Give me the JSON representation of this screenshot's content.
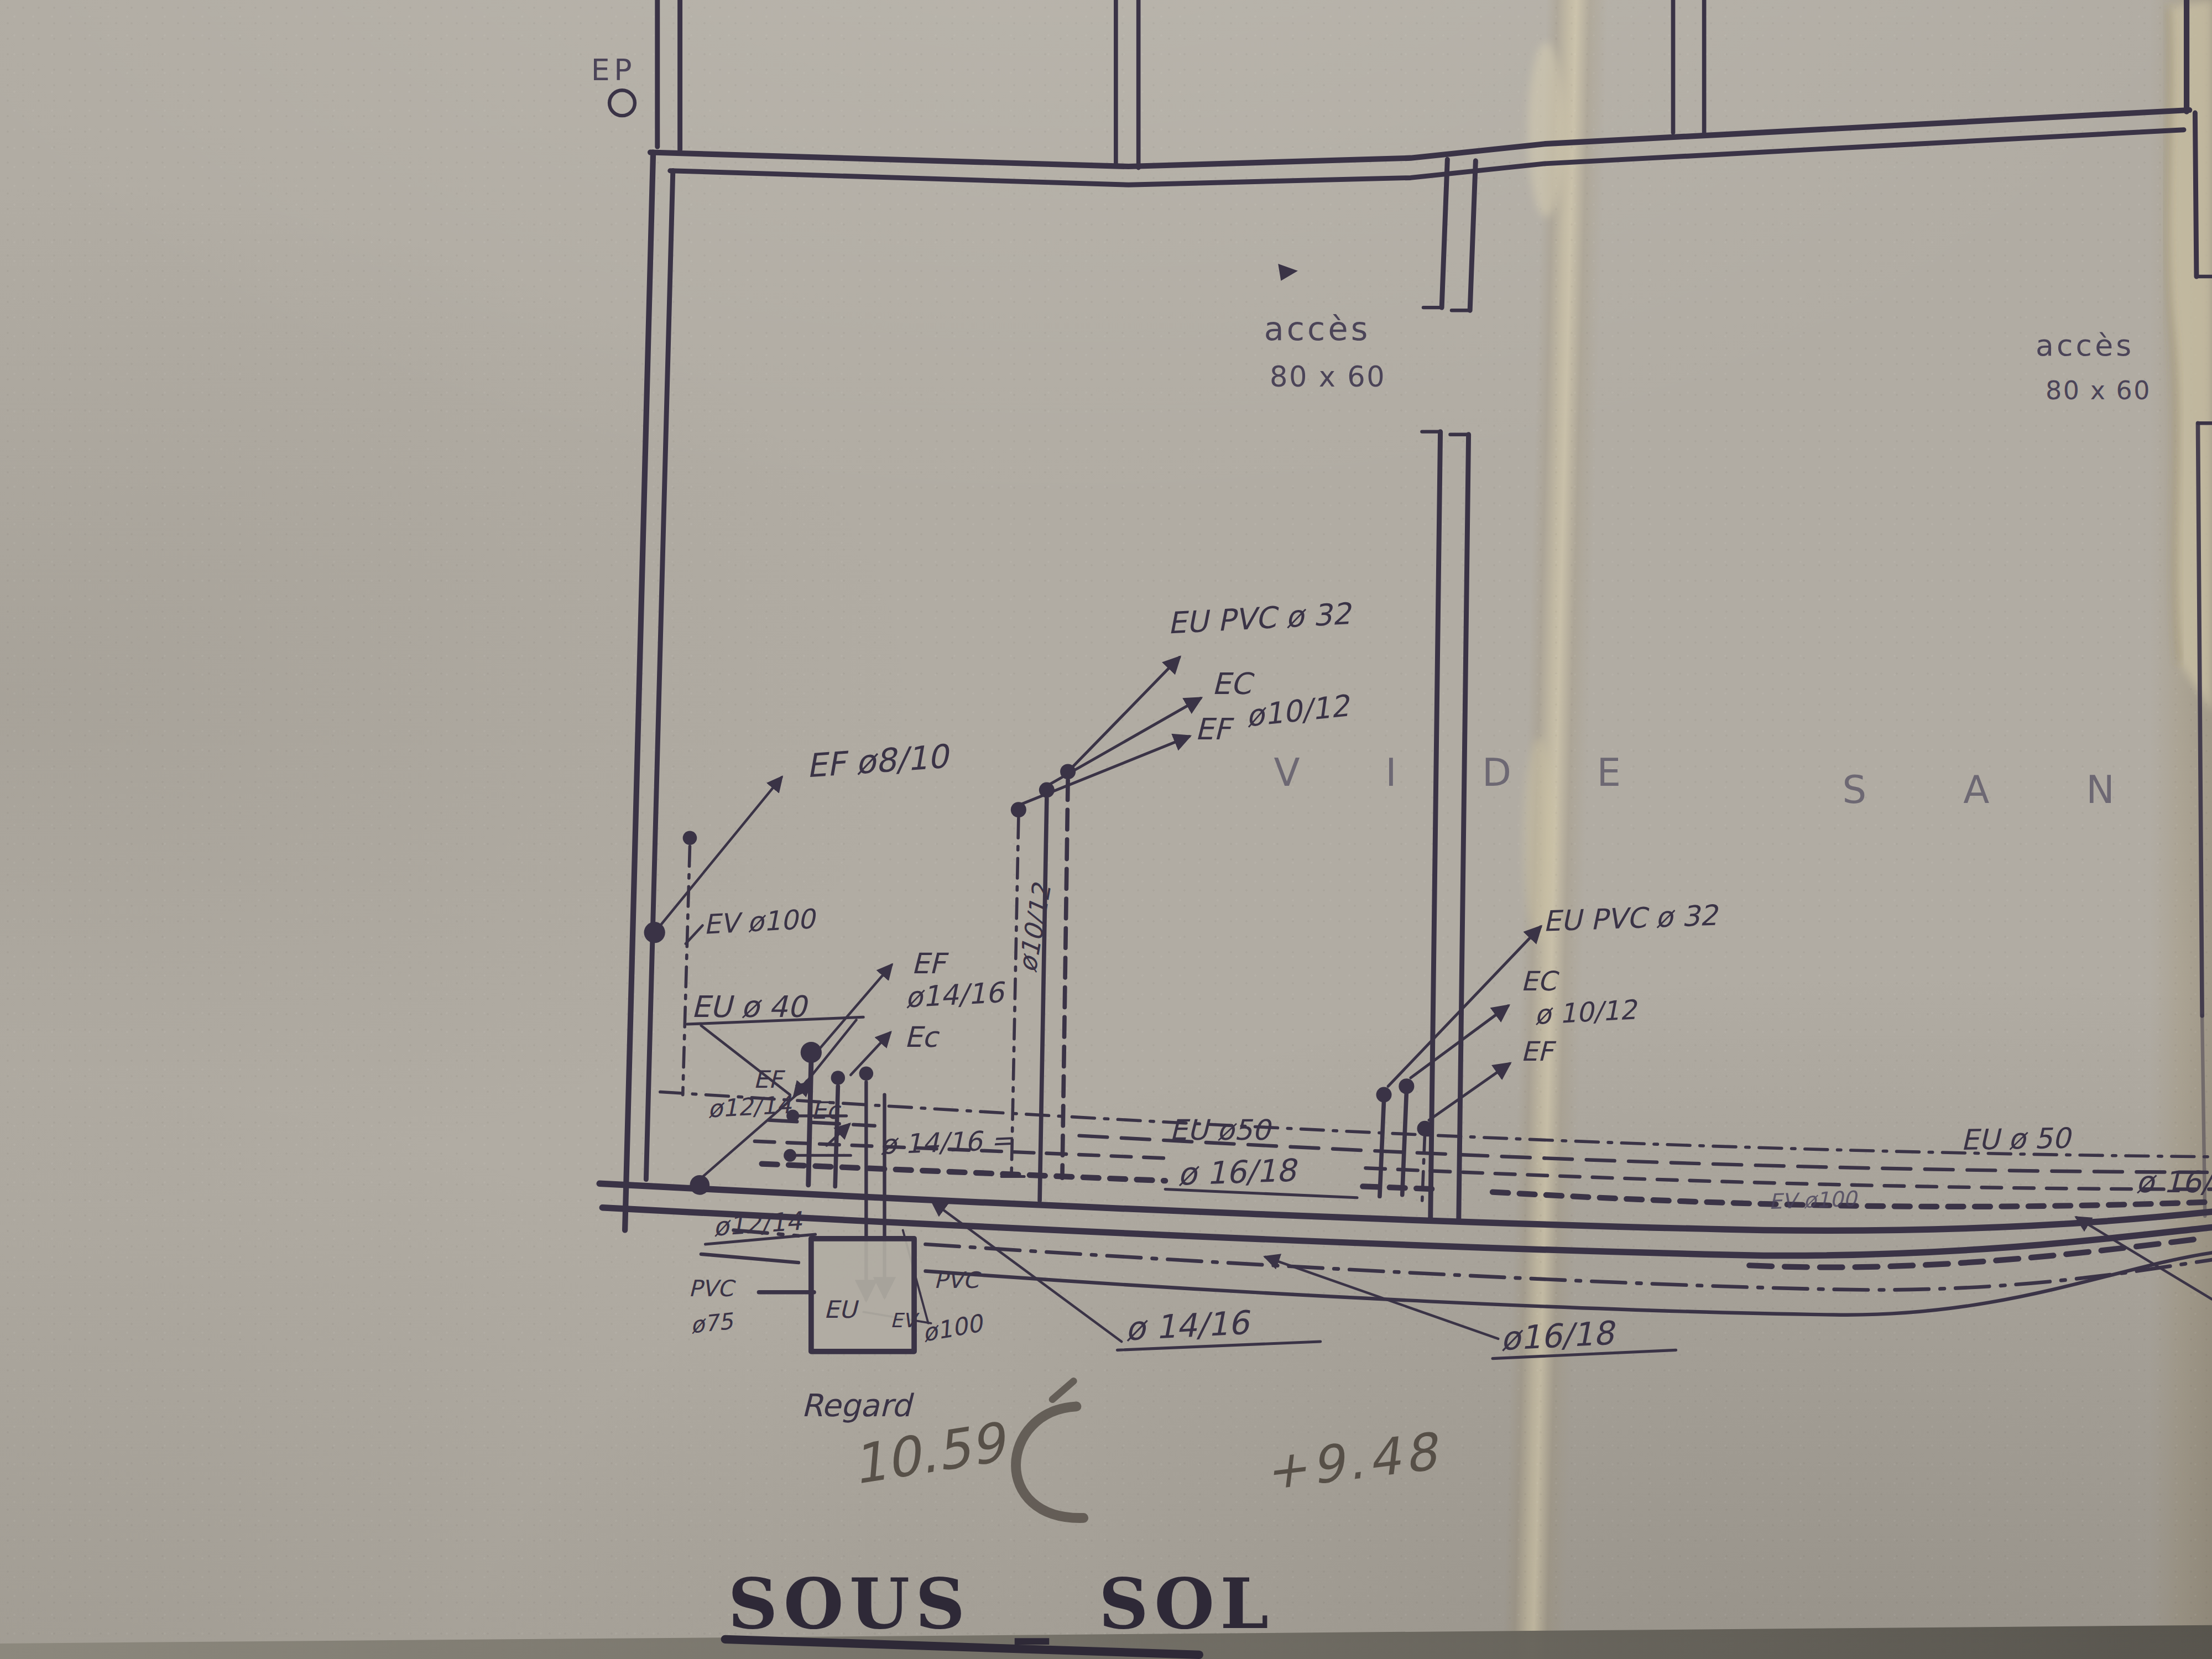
{
  "title": {
    "text": "SOUS _ SOL"
  },
  "colors": {
    "paper": "#b1aca3",
    "ink": "#3a3346",
    "handwriting_ink": "#332e44",
    "pencil": "#4c453d",
    "crease": "#d6c9a2"
  },
  "drawing": {
    "floor_name": "SOUS _ SOL",
    "zone_text": "VIDE SANITAIRE",
    "hatches": [
      {
        "label": "acc\u00e8s",
        "size": "80 x 60"
      },
      {
        "label": "acc\u00e8s",
        "size": "80 x 60"
      }
    ],
    "manhole": {
      "label": "Regard",
      "level_note": "10.59"
    },
    "pencil_level_note": "+9.48"
  },
  "annotations": [
    {
      "name": "label-ep",
      "t": "EP",
      "x": 419,
      "y": 57,
      "s": 21,
      "cls": "print",
      "ls": 3
    },
    {
      "name": "label-acces-left",
      "t": "acc\u00e8s",
      "x": 896,
      "y": 241,
      "s": 23,
      "cls": "print",
      "ls": 2
    },
    {
      "name": "label-acces-left-size",
      "t": "80 x 60",
      "x": 900,
      "y": 274,
      "s": 20,
      "cls": "print",
      "ls": 1
    },
    {
      "name": "label-acces-right",
      "t": "acc\u00e8s",
      "x": 1443,
      "y": 252,
      "s": 21,
      "cls": "print",
      "ls": 2
    },
    {
      "name": "label-acces-right-size",
      "t": "80 x 60",
      "x": 1450,
      "y": 283,
      "s": 18,
      "cls": "print",
      "ls": 1
    },
    {
      "name": "label-vide",
      "t": "V I D E",
      "x": 903,
      "y": 557,
      "s": 27,
      "cls": "print wide",
      "ls": 26
    },
    {
      "name": "label-sanitaire",
      "t": "S A N I",
      "x": 1306,
      "y": 569,
      "s": 27,
      "cls": "print wide",
      "ls": 30
    },
    {
      "name": "label-eu-pvc-32-left",
      "t": "EU PVC \u00f8 32",
      "x": 828,
      "y": 449,
      "s": 21,
      "cls": "hand",
      "rot": -3
    },
    {
      "name": "label-ec-left-top",
      "t": "EC",
      "x": 859,
      "y": 492,
      "s": 21,
      "cls": "hand"
    },
    {
      "name": "label-ef-left-top",
      "t": "EF",
      "x": 847,
      "y": 524,
      "s": 21,
      "cls": "hand"
    },
    {
      "name": "label-dia-10-12-top",
      "t": "\u00f810/12",
      "x": 884,
      "y": 515,
      "s": 21,
      "cls": "hand",
      "rot": -6
    },
    {
      "name": "label-ef-8-10",
      "t": "EF \u00f88/10",
      "x": 572,
      "y": 551,
      "s": 23,
      "cls": "hand",
      "rot": -4
    },
    {
      "name": "label-ev-100-left",
      "t": "EV \u00f8100",
      "x": 499,
      "y": 662,
      "s": 19,
      "cls": "hand",
      "rot": -3
    },
    {
      "name": "label-eu-40",
      "t": "EU \u00f8 40",
      "x": 490,
      "y": 721,
      "s": 21,
      "cls": "hand"
    },
    {
      "name": "label-ef-mid",
      "t": "EF",
      "x": 646,
      "y": 690,
      "s": 20,
      "cls": "hand"
    },
    {
      "name": "label-dia-14-16-mid",
      "t": "\u00f814/16",
      "x": 642,
      "y": 714,
      "s": 20,
      "cls": "hand",
      "rot": -3
    },
    {
      "name": "label-ec-mid",
      "t": "Ec",
      "x": 641,
      "y": 742,
      "s": 20,
      "cls": "hand"
    },
    {
      "name": "label-ef-small",
      "t": "EF",
      "x": 534,
      "y": 771,
      "s": 17,
      "cls": "hand"
    },
    {
      "name": "label-dia-12-14-small",
      "t": "\u00f812/14",
      "x": 502,
      "y": 792,
      "s": 17,
      "cls": "hand",
      "rot": -3
    },
    {
      "name": "label-ec-small",
      "t": "Ec",
      "x": 575,
      "y": 793,
      "s": 17,
      "cls": "hand"
    },
    {
      "name": "label-dia-12-14-bottom",
      "t": "\u00f812/14",
      "x": 506,
      "y": 876,
      "s": 18,
      "cls": "hand",
      "rot": -4
    },
    {
      "name": "label-dia-10-12-riser",
      "t": "\u00f810/12",
      "x": 734,
      "y": 690,
      "s": 18,
      "cls": "hand",
      "rot": -80
    },
    {
      "name": "label-dia-14-16-run",
      "t": "\u00f8 14/16 =",
      "x": 624,
      "y": 818,
      "s": 19,
      "cls": "hand",
      "rot": -2
    },
    {
      "name": "label-eu-50-mid",
      "t": "EU \u00f850",
      "x": 829,
      "y": 808,
      "s": 20,
      "cls": "hand"
    },
    {
      "name": "label-dia-16-18-mid",
      "t": "\u00f8 16/18",
      "x": 835,
      "y": 840,
      "s": 22,
      "cls": "hand",
      "rot": -2
    },
    {
      "name": "label-eu-pvc-32-right",
      "t": "EU PVC \u00f8 32",
      "x": 1094,
      "y": 660,
      "s": 20,
      "cls": "hand",
      "rot": -2
    },
    {
      "name": "label-ec-right",
      "t": "EC",
      "x": 1078,
      "y": 702,
      "s": 19,
      "cls": "hand"
    },
    {
      "name": "label-dia-10-12-right",
      "t": "\u00f8 10/12",
      "x": 1088,
      "y": 726,
      "s": 19,
      "cls": "hand",
      "rot": -3
    },
    {
      "name": "label-ef-right",
      "t": "EF",
      "x": 1078,
      "y": 752,
      "s": 19,
      "cls": "hand"
    },
    {
      "name": "label-eu-50-right",
      "t": "EU \u00f8 50",
      "x": 1390,
      "y": 815,
      "s": 20,
      "cls": "hand",
      "rot": -1
    },
    {
      "name": "label-ev-100-right",
      "t": "EV  \u00f8100",
      "x": 1254,
      "y": 857,
      "s": 15,
      "cls": "hand hand-light",
      "rot": -2
    },
    {
      "name": "label-dia-16-18-right-clipped",
      "t": "\u00f8 16/18",
      "x": 1514,
      "y": 845,
      "s": 21,
      "cls": "hand"
    },
    {
      "name": "label-dia-14-16-callout",
      "t": "\u00f8 14/16",
      "x": 798,
      "y": 950,
      "s": 23,
      "cls": "hand",
      "rot": -3
    },
    {
      "name": "label-dia-16-18-callout",
      "t": "\u00f816/18",
      "x": 1064,
      "y": 957,
      "s": 23,
      "cls": "hand",
      "rot": -3
    },
    {
      "name": "label-pvc-left",
      "t": "PVC",
      "x": 488,
      "y": 919,
      "s": 16,
      "cls": "hand"
    },
    {
      "name": "label-dia-75",
      "t": "\u00f875",
      "x": 490,
      "y": 945,
      "s": 16,
      "cls": "hand",
      "rot": -6
    },
    {
      "name": "label-eu-regard",
      "t": "EU",
      "x": 584,
      "y": 934,
      "s": 17,
      "cls": "hand"
    },
    {
      "name": "label-ev-regard",
      "t": "EV",
      "x": 631,
      "y": 941,
      "s": 14,
      "cls": "hand"
    },
    {
      "name": "label-pvc-right",
      "t": "PVC",
      "x": 662,
      "y": 913,
      "s": 16,
      "cls": "hand"
    },
    {
      "name": "label-dia-100",
      "t": "\u00f8100",
      "x": 655,
      "y": 951,
      "s": 17,
      "cls": "hand",
      "rot": -10
    },
    {
      "name": "label-regard",
      "t": "Regard",
      "x": 568,
      "y": 1004,
      "s": 22,
      "cls": "hand"
    },
    {
      "name": "label-level-10-59",
      "t": "10.59",
      "x": 606,
      "y": 1052,
      "s": 38,
      "cls": "pencil",
      "rot": -9
    },
    {
      "name": "label-level-9-48",
      "t": "+9.48",
      "x": 898,
      "y": 1056,
      "s": 36,
      "cls": "pencil",
      "rot": -7,
      "ls": 3
    },
    {
      "name": "title-sous-sol",
      "t": "SOUS _ SOL",
      "x": 516,
      "y": 1154,
      "s": 49,
      "cls": "stencil",
      "ls": 4,
      "ws": 10
    }
  ]
}
